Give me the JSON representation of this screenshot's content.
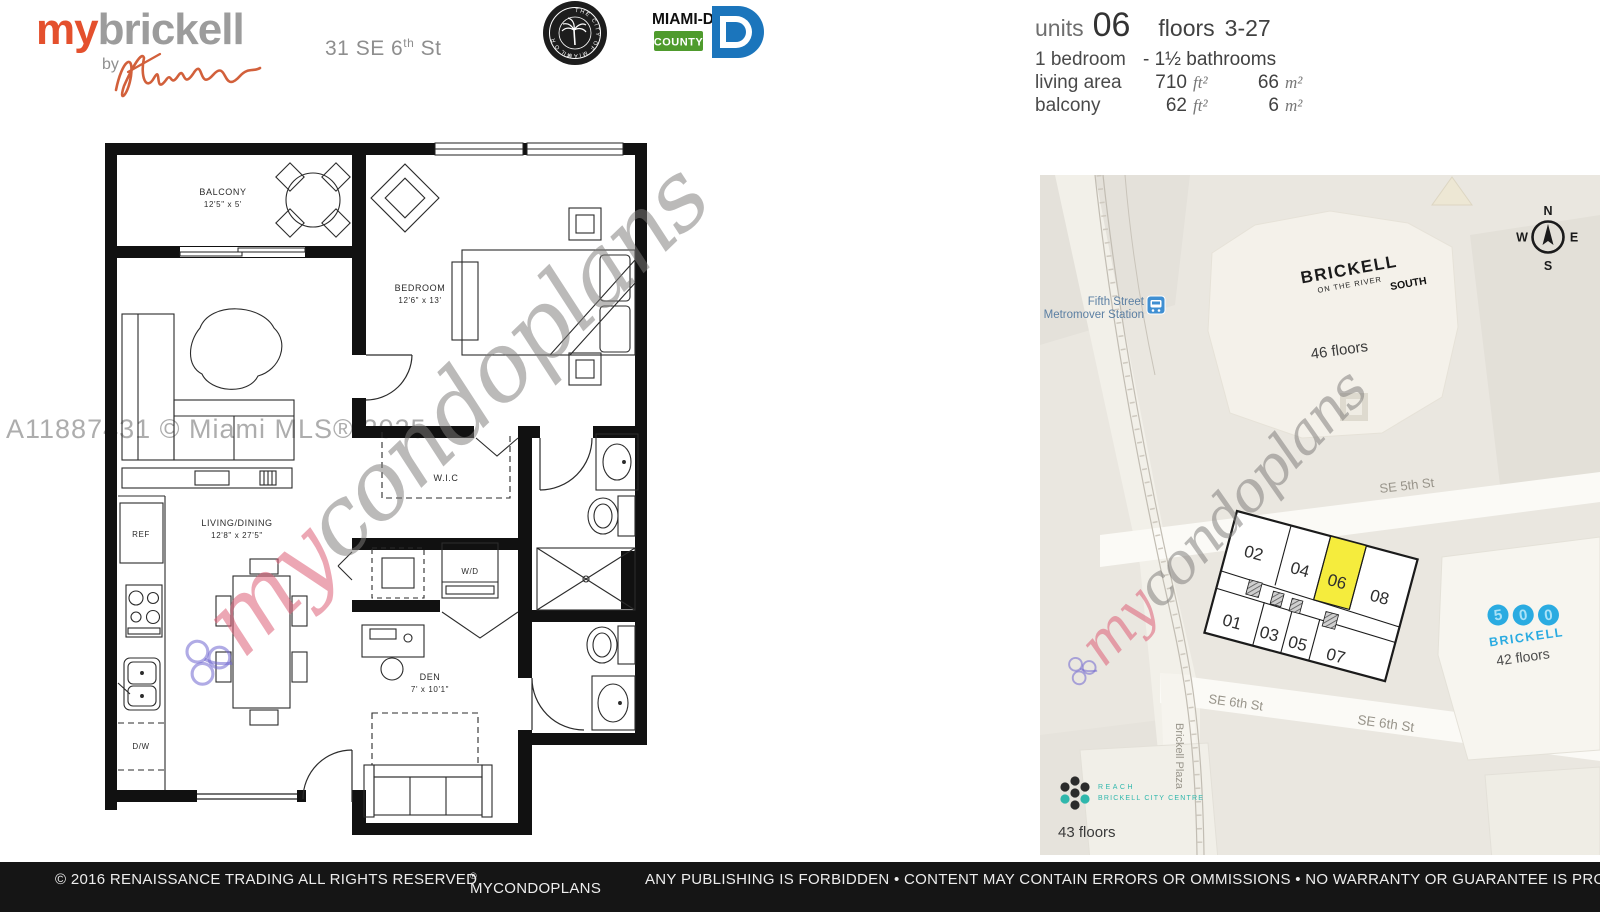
{
  "header": {
    "logo_my": "my",
    "logo_brickell": "brickell",
    "logo_by": "by",
    "logo_signature": "Karim",
    "address_prefix": "31 SE 6",
    "address_sup": "th",
    "address_suffix": " St",
    "seal_ring_text": "THE CITY OF MIAMI",
    "seal_banner_text": "FLORIDA",
    "county_name": "MIAMI-DADE",
    "county_sub": "COUNTY"
  },
  "unit_info": {
    "units_label": "units",
    "units_value": "06",
    "floors_label": "floors",
    "floors_value": "3-27",
    "bedrooms": "1 bedroom",
    "bathrooms": "- 1½ bathrooms",
    "living_area_label": "living area",
    "living_area_ft": "710",
    "living_area_m": "66",
    "balcony_label": "balcony",
    "balcony_ft": "62",
    "balcony_m": "6",
    "unit_ft": "ft²",
    "unit_m": "m²"
  },
  "floorplan": {
    "balcony_name": "BALCONY",
    "balcony_dims": "12'5\" x 5'",
    "bedroom_name": "BEDROOM",
    "bedroom_dims": "12'6\" x 13'",
    "living_name": "LIVING/DINING",
    "living_dims": "12'8\" x 27'5\"",
    "wic_name": "W.I.C",
    "wd_name": "W/D",
    "den_name": "DEN",
    "den_dims": "7' x 10'1\"",
    "ref_name": "REF",
    "dw_name": "D/W"
  },
  "watermark": {
    "script_my": "my",
    "script_rest": "condoplans",
    "mls": "A11887431 © Miami MLS® 2025"
  },
  "map": {
    "station_line1": "Fifth Street",
    "station_line2": "Metromover Station",
    "main_building_name": "BRICKELL",
    "main_building_sub": "ON THE RIVER",
    "main_building_tag": "SOUTH",
    "main_building_floors": "46 floors",
    "street_se5": "SE 5th St",
    "street_se6_a": "SE 6th St",
    "street_se6_b": "SE 6th St",
    "street_plaza": "Brickell Plaza",
    "compass": {
      "n": "N",
      "e": "E",
      "s": "S",
      "w": "W"
    },
    "keyplan": {
      "top_units": [
        "02",
        "04",
        "06",
        "08"
      ],
      "bottom_units": [
        "01",
        "03",
        "05",
        "07"
      ],
      "highlighted_unit": "06",
      "highlight_color": "#F5EC3D"
    },
    "building_500": {
      "digits": [
        "5",
        "0",
        "0"
      ],
      "name": "BRICKELL",
      "floors": "42 floors",
      "color": "#2AABE1"
    },
    "reach": {
      "line1": "REACH",
      "line2": "BRICKELL CITY CENTRE",
      "floors": "43 floors",
      "color": "#2FB7AC"
    }
  },
  "footer": {
    "copyright": "© 2016 RENAISSANCE TRADING ALL RIGHTS RESERVED",
    "brand": "MYCONDOPLANS",
    "brand_reg": "®",
    "disclaimer": "ANY PUBLISHING IS FORBIDDEN • CONTENT MAY CONTAIN ERRORS OR OMMISSIONS • NO WARRANTY OR GUARANTEE IS PROVIDED"
  },
  "colors": {
    "accent_orange": "#E4502D",
    "logo_gray": "#9C9C9C",
    "county_blue": "#1B75BC",
    "county_green": "#4F9B2D",
    "map_blue": "#2AABE1",
    "reach_teal": "#2FB7AC",
    "keyplan_yellow": "#F5EC3D",
    "station_blue": "#3F8FD2"
  }
}
